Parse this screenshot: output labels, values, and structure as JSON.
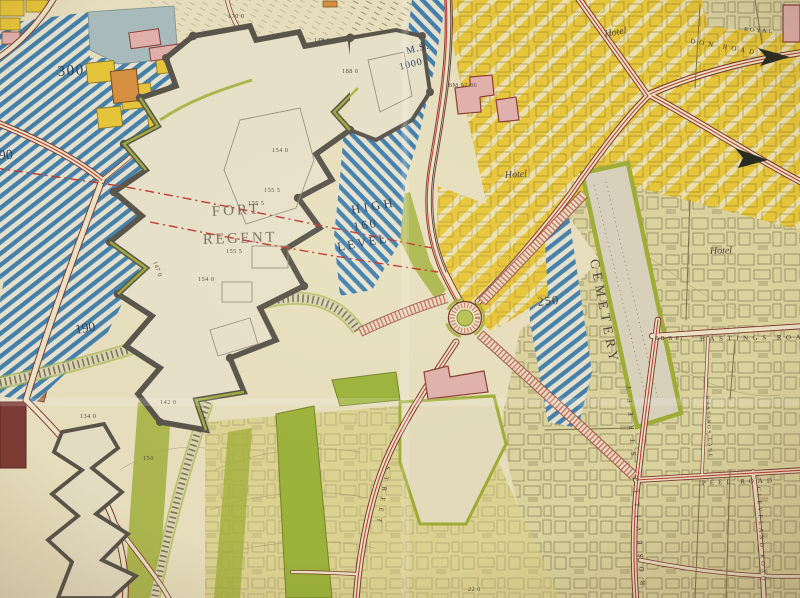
{
  "map": {
    "labels": {
      "zone_300": "300",
      "zone_190_a": "190",
      "zone_190_b": "190",
      "zone_250": "250",
      "ms_line1": "M.S.",
      "ms_line2": "1000",
      "high_line1": "HIGH",
      "high_line2": "160",
      "high_line3": "LEVEL",
      "fort_line1": "FORT",
      "fort_line2": "REGENT",
      "cemetery": "CEMETERY",
      "hotel_don_road": "Hotel",
      "hotel_colomberie": "Hotel",
      "hotel_georgetown": "Hotel",
      "royal": "ROYAL"
    },
    "streets": {
      "don_road": "DON ROAD",
      "hastings_road": "HASTINGS ROAD",
      "hastings_lane": "HASTINGS LANE",
      "lb_b81": "LB B 81",
      "peel_road": "PEEL ROAD",
      "roseville_street": "ROSEVILLE STREET",
      "cleveland_road": "CLEVELAND ROAD",
      "green_street": "STREET"
    },
    "elevations": {
      "e1": "170 0",
      "e2": "148 0",
      "e3": "188 0",
      "e4": "154 0",
      "e5": "155 5",
      "e6": "155 5",
      "e7": "155 5",
      "e8": "154 0",
      "e9": "147 0",
      "e10": "142 0",
      "e11": "134 0",
      "e12": "150",
      "e13": "22 0",
      "e14": "BM 97 86"
    },
    "colors": {
      "paper_cream": "#e8e1c0",
      "khaki_urban": "#ded6a2",
      "zone_yellow": "#eac83a",
      "zone_blue": "#4180ad",
      "olive_green": "#a2b23c",
      "bright_green": "#9cb43a",
      "building_pink": "#e2b2ae",
      "building_orange": "#d6913f",
      "terrace_brown": "#aa7249",
      "road_casing_maroon": "#7c3530",
      "route_red": "#bf3a30",
      "fort_wall_grey": "#57534a",
      "navy_text": "#2c3a55"
    }
  }
}
